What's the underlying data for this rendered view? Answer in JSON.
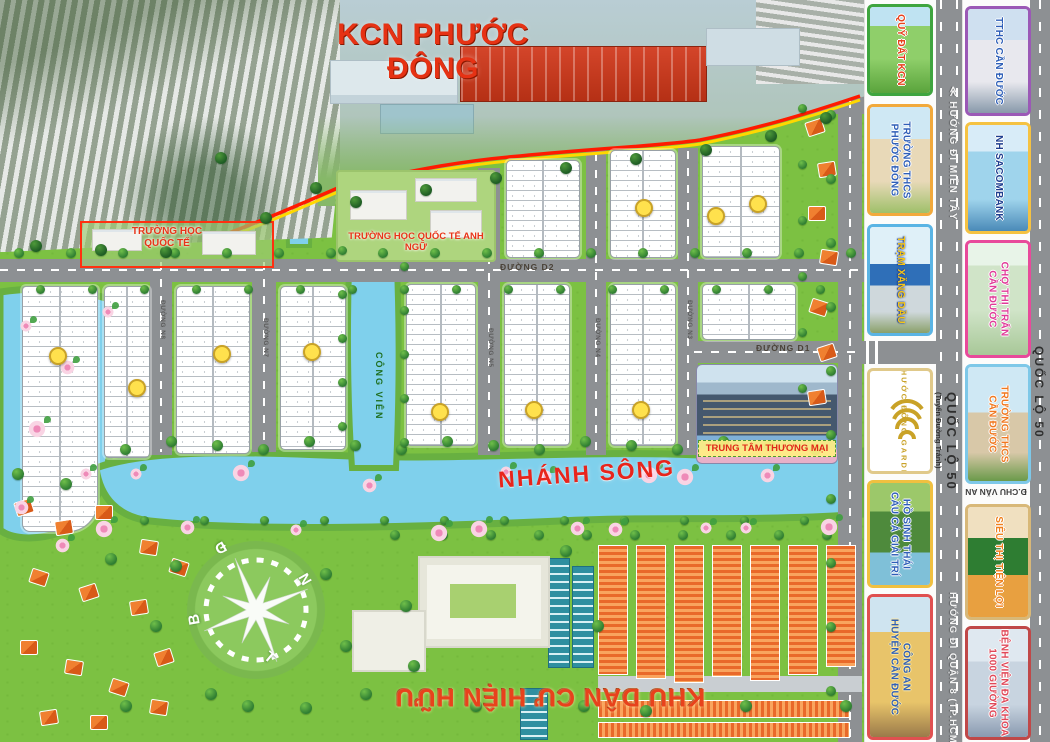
{
  "title": "KCN PHƯỚC ĐÔNG",
  "palette": {
    "title_red": "#e63214",
    "map_green": "#7cc142",
    "road_gray": "#8d9093",
    "river_blue": "#7fd0ec",
    "badge_yellow": "#ffe14d",
    "boundary_red": "#ff1a00",
    "boundary_yellow": "#ffd800",
    "label_red": "#e8251c",
    "card_borders_inner": [
      "#3fa53f",
      "#f2a93b",
      "#5ab4e4",
      "#e0c98a",
      "#f0c040",
      "#e05050"
    ],
    "card_borders_outer": [
      "#9b59b6",
      "#f5c242",
      "#e84a9b",
      "#7ec8e8",
      "#d8b878",
      "#c04848"
    ]
  },
  "map": {
    "labels": {
      "school_international": "TRƯỜNG HỌC\nQUỐC TẾ",
      "school_english": "TRƯỜNG HỌC QUỐC TẾ ANH NGỮ",
      "river": "NHÁNH SÔNG",
      "mall": "TRUNG TÂM THƯƠNG MẠI",
      "existing_residential": "KHU DÂN CƯ HIỆN HỮU",
      "park": "CÔNG VIÊN"
    },
    "roads": {
      "d1_right": "ĐƯỜNG D1",
      "d2": "ĐƯỜNG D2",
      "n8": "ĐƯỜNG N8",
      "n7": "ĐƯỜNG N7",
      "n5": "ĐƯỜNG N5",
      "n4": "ĐƯỜNG N4",
      "n3": "ĐƯỜNG N3"
    },
    "compass": [
      "Đ",
      "N",
      "B",
      "T"
    ]
  },
  "right_panel": {
    "inner_strip": [
      {
        "label": "QUỸ ĐẤT KCN"
      },
      {
        "label": "TRƯỜNG THCS\nPHƯỚC ĐÔNG"
      },
      {
        "label": "TRẠM XĂNG DẦU"
      },
      {
        "label": "PHƯỚC ĐÔNG GARDEN"
      },
      {
        "label": "HỒ SINH THÁI\nCÂU CÁ GIẢI TRÍ"
      },
      {
        "label": "CÔNG AN\nHUYỆN CẦN ĐƯỚC"
      }
    ],
    "outer_strip": [
      {
        "label": "TTHC CẦN ĐƯỚC"
      },
      {
        "label": "NH SACOMBANK"
      },
      {
        "label": "CHỢ THỊ TRẤN\nCẦN ĐƯỚC"
      },
      {
        "label": "TRƯỜNG THCS\nCẦN ĐƯỚC"
      },
      {
        "label": "SIÊU THỊ TIỆN LỢI"
      },
      {
        "label": "BỆNH VIỆN ĐA KHOA\n1000 GIƯỜNG"
      }
    ],
    "road_labels": {
      "mien_tay": "≪ HƯỚNG ĐI MIỀN TÂY",
      "ql50_bypass": "QUỐC LỘ 50",
      "ql50_bypass_sub": "(Tuyến Đường Tránh)",
      "quan8": "HƯỚNG ĐI QUẬN 8 (TP.HCM) ≫",
      "ql50": "QUỐC LỘ 50",
      "chu_van_an": "Đ.CHU VĂN AN"
    }
  }
}
